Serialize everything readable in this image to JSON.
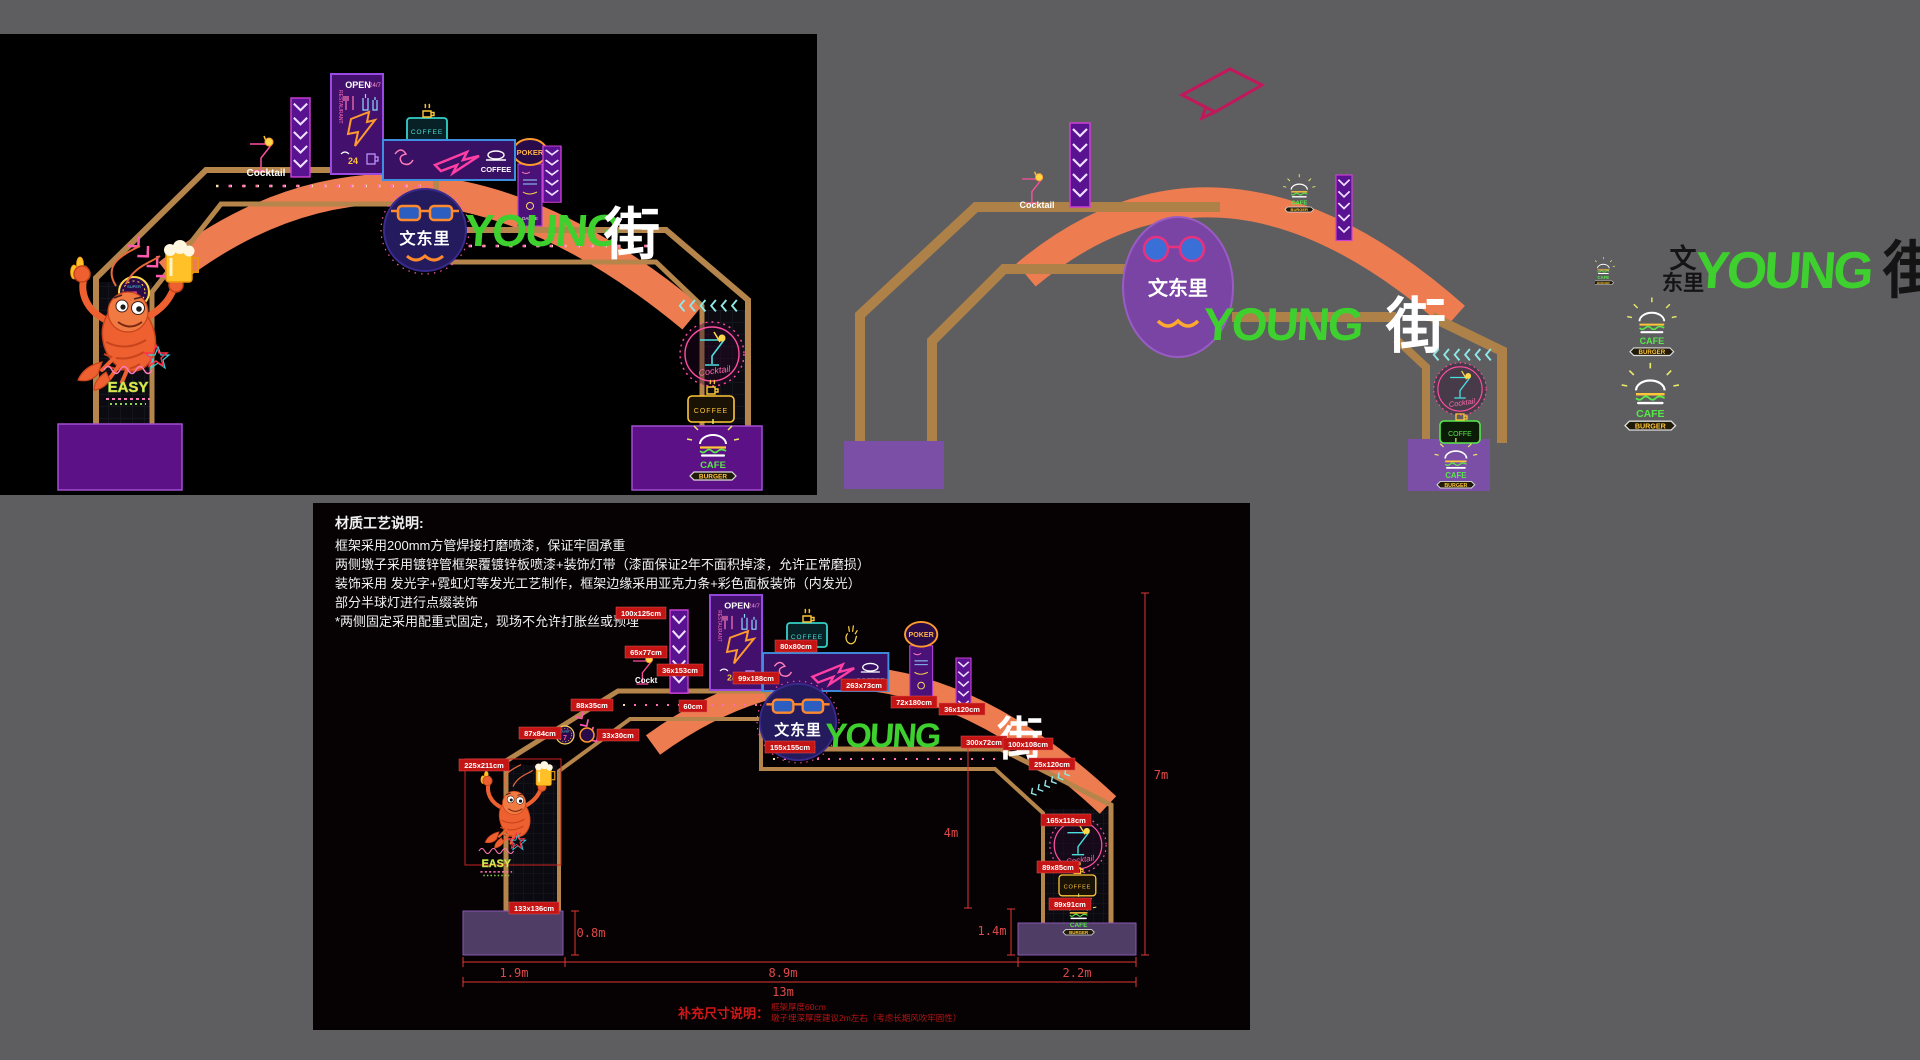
{
  "colors": {
    "background": "#5e5e60",
    "panel_black": "#000000",
    "frame_tan": "#b5854b",
    "arc_orange": "#ed7c50",
    "plinth_purple_render": "#5c1186",
    "plinth_purple_3d": "#7b4fa5",
    "plinth_purple_drawing": "#4f3d66",
    "young_green": "#3ed02e",
    "label_red": "#c41414",
    "dimension_red": "#e04848",
    "neon_pink": "#ff4fa0",
    "neon_cyan": "#4ae0e0",
    "neon_yellow": "#ffc63a",
    "badge_navy": "#241b5e",
    "badge_purple_3d": "#7a44a4"
  },
  "scene": {
    "cocktail_label": "Cocktail",
    "cocktail_script": "Cocktail",
    "open": "OPEN",
    "hours": "24/7",
    "restaurant": "RESTAURANT",
    "twenty_four": "24",
    "coffee": "COFFEE",
    "coffe": "COFFE",
    "poker": "POKER",
    "dance": "DANCE",
    "badge_name": "文东里",
    "young": "YOUNG",
    "street": "街",
    "easy": "EASY",
    "seven": "7",
    "super": "SUPER",
    "cafe": "CAFE",
    "burger": "BURGER"
  },
  "logo": {
    "wen": "文",
    "dongli": "东里",
    "young": "YOUNG",
    "street": "街"
  },
  "technical_drawing": {
    "notes": {
      "title": "材质工艺说明:",
      "lines": [
        "框架采用200mm方管焊接打磨喷漆，保证牢固承重",
        "两侧墩子采用镀锌管框架覆镀锌板喷漆+装饰灯带（漆面保证2年不面积掉漆，允许正常磨损）",
        "装饰采用 发光字+霓虹灯等发光工艺制作，框架边缘采用亚克力条+彩色面板装饰（内发光）",
        "部分半球灯进行点缀装饰",
        "*两侧固定采用配重式固定，现场不允许打胀丝或预埋"
      ]
    },
    "supplement": {
      "title": "补充尺寸说明：",
      "lines": [
        "框架厚度60cm",
        "墩子埋深厚度建议2m左右（考虑长期风吹牢固性）"
      ]
    },
    "dimensions": {
      "left_base": "1.9m",
      "left_plinth_height": "0.8m",
      "span": "8.9m",
      "right_base": "2.2m",
      "total_width": "13m",
      "clear_height": "4m",
      "total_height": "7m",
      "right_plinth_height": "1.4m"
    },
    "size_labels": {
      "banner": "100x125cm",
      "martini": "65x77cm",
      "banner2": "36x153cm",
      "slope_chevrons": "88x35cm",
      "super7": "87x84cm",
      "round_sign": "33x30cm",
      "shrimp": "225x211cm",
      "easy": "133x136cm",
      "open_poster": "99x188cm",
      "coffee_arc": "80x80cm",
      "blue_panel": "263x73cm",
      "poker": "72x180cm",
      "badge": "155x155cm",
      "beam": "60cm",
      "right_chevron": "36x120cm",
      "young": "300x72cm",
      "street": "100x108cm",
      "shoulder_chevrons": "25x120cm",
      "cocktail_circle": "165x118cm",
      "coffee_sign": "89x85cm",
      "cafe_burger": "89x91cm",
      "cocktail_partial": "Cockt"
    }
  }
}
